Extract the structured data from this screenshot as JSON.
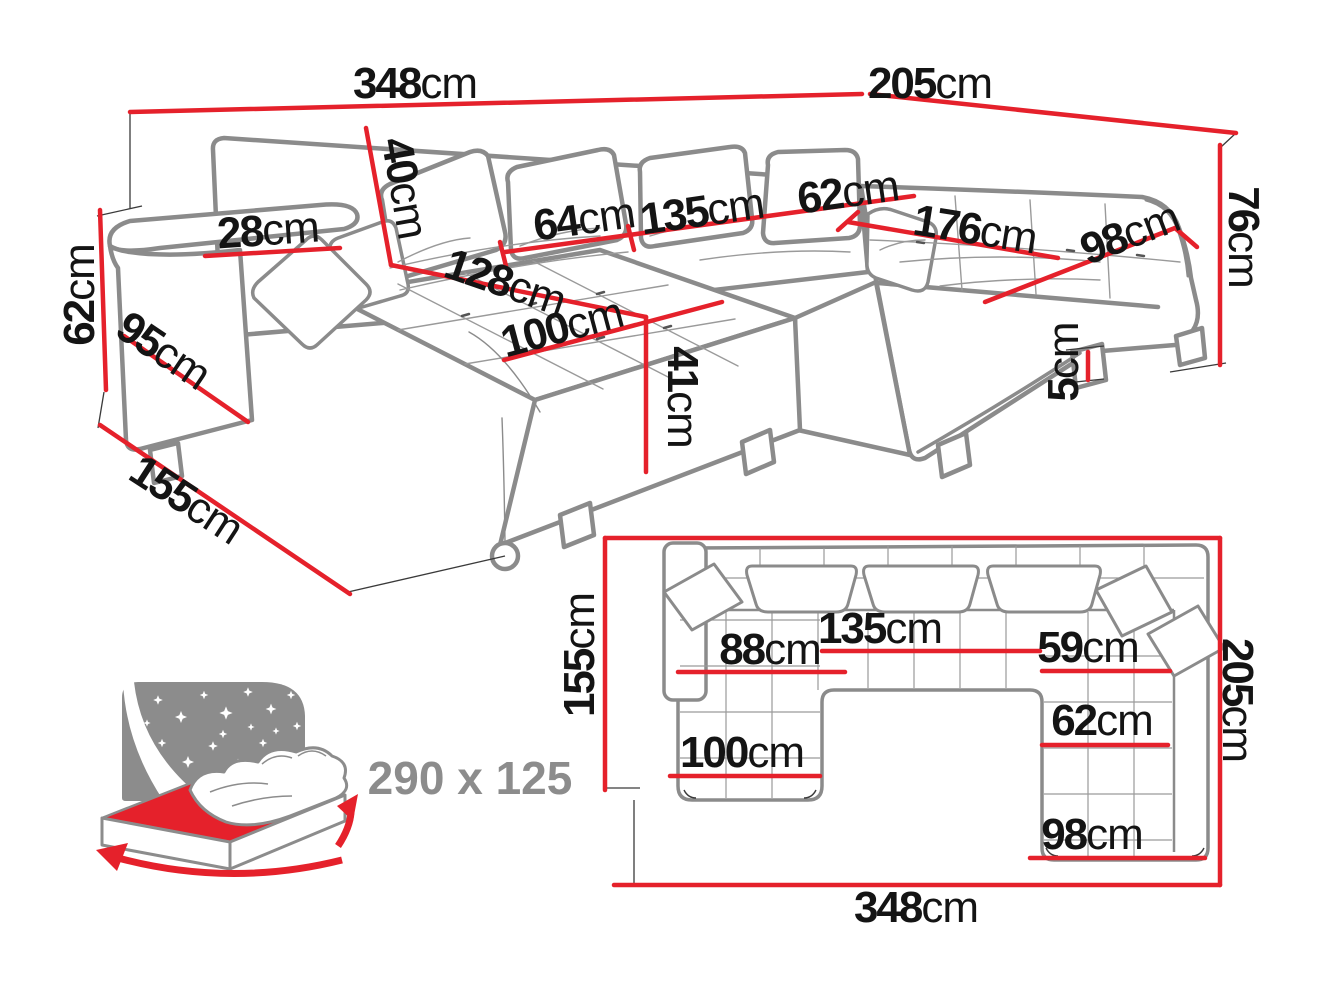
{
  "title": "corner-sofa-dimensions-diagram",
  "colors": {
    "accent_red": "#e5212b",
    "outline_gray": "#8b8b8b",
    "detail_black": "#3a3a3a",
    "icon_gray": "#8c8c8c",
    "text_black": "#141414"
  },
  "perspective_view": {
    "total_back_width": {
      "value": "348",
      "unit": "cm"
    },
    "right_side_width": {
      "value": "205",
      "unit": "cm"
    },
    "armrest_height": {
      "value": "62",
      "unit": "cm"
    },
    "back_cushion_height": {
      "value": "40",
      "unit": "cm"
    },
    "armrest_top_width": {
      "value": "28",
      "unit": "cm"
    },
    "seat_depth": {
      "value": "64",
      "unit": "cm"
    },
    "center_seat_width": {
      "value": "135",
      "unit": "cm"
    },
    "corner_seat_width": {
      "value": "62",
      "unit": "cm"
    },
    "right_seat_width": {
      "value": "176",
      "unit": "cm"
    },
    "end_seat_width": {
      "value": "98",
      "unit": "cm"
    },
    "backrest_height": {
      "value": "76",
      "unit": "cm"
    },
    "chaise_length": {
      "value": "128",
      "unit": "cm"
    },
    "chaise_width": {
      "value": "100",
      "unit": "cm"
    },
    "seat_height": {
      "value": "41",
      "unit": "cm"
    },
    "leg_height": {
      "value": "5",
      "unit": "cm"
    },
    "armrest_depth": {
      "value": "95",
      "unit": "cm"
    },
    "side_depth": {
      "value": "155",
      "unit": "cm"
    }
  },
  "plan_view": {
    "left_side_depth": {
      "value": "155",
      "unit": "cm"
    },
    "chaise_seat_width": {
      "value": "88",
      "unit": "cm"
    },
    "center_seat_width": {
      "value": "135",
      "unit": "cm"
    },
    "corner_seat_width": {
      "value": "59",
      "unit": "cm"
    },
    "right_seat_width": {
      "value": "62",
      "unit": "cm"
    },
    "chaise_width": {
      "value": "100",
      "unit": "cm"
    },
    "end_seat_width": {
      "value": "98",
      "unit": "cm"
    },
    "right_side_depth": {
      "value": "205",
      "unit": "cm"
    },
    "total_width": {
      "value": "348",
      "unit": "cm"
    }
  },
  "sleeping_function": {
    "size": "290 x 125"
  }
}
